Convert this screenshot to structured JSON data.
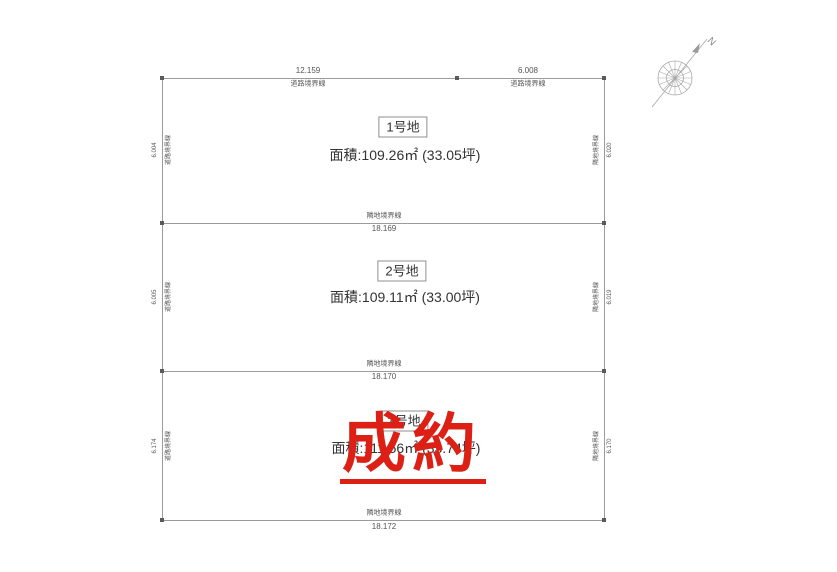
{
  "colors": {
    "line": "#9b9b9b",
    "text": "#555555",
    "lot_text": "#333333",
    "stamp_red": "#dd2015"
  },
  "compass": {
    "north_label": "N"
  },
  "top_boundaries": [
    {
      "length": "12.159",
      "label": "道路境界線"
    },
    {
      "length": "6.008",
      "label": "道路境界線"
    }
  ],
  "dividers": [
    {
      "label": "隣地境界線",
      "length": "18.169"
    },
    {
      "label": "隣地境界線",
      "length": "18.170"
    },
    {
      "label": "隣地境界線",
      "length": "18.172"
    }
  ],
  "lots": [
    {
      "name": "1号地",
      "area": "面積:109.26㎡ (33.05坪)",
      "left_length": "6.004",
      "left_label": "道路境界線",
      "right_label": "隣地境界線",
      "right_length": "6.020"
    },
    {
      "name": "2号地",
      "area": "面積:109.11㎡ (33.00坪)",
      "left_length": "6.005",
      "left_label": "道路境界線",
      "right_label": "隣地境界線",
      "right_length": "6.019"
    },
    {
      "name": "3号地",
      "area": "面積:111.56㎡ (33.74坪)",
      "left_length": "6.174",
      "left_label": "道路境界線",
      "right_label": "隣地境界線",
      "right_length": "6.170"
    }
  ],
  "stamp": {
    "text": "成約"
  }
}
